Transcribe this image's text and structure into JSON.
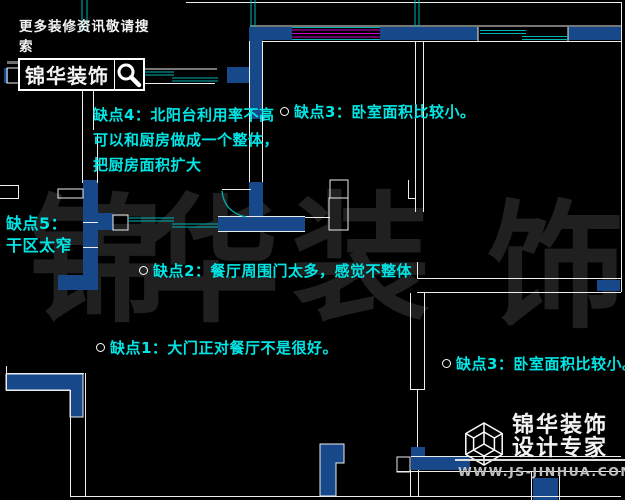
{
  "branding": {
    "header": {
      "tagline": "更多装修资讯敬请搜索",
      "logo_text": "锦华装饰",
      "search_icon": "magnifier-icon"
    },
    "footer": {
      "company": "锦华装饰",
      "slogan": "设计专家",
      "website": "WWW.JS-JINHUA.COM",
      "cube_icon": "wireframe-cube-icon"
    }
  },
  "watermark": {
    "chars": [
      "锦",
      "华",
      "装",
      "饰"
    ]
  },
  "annotations": [
    {
      "id": "defect-4",
      "marker": false,
      "lines": [
        "缺点4：北阳台利用率不高",
        "可以和厨房做成一个整体，",
        "把厨房面积扩大"
      ]
    },
    {
      "id": "defect-3-top",
      "marker": true,
      "text": "缺点3：卧室面积比较小。"
    },
    {
      "id": "defect-5",
      "marker": false,
      "lines": [
        "缺点5：",
        "干区太窄"
      ]
    },
    {
      "id": "defect-2",
      "marker": true,
      "text": "缺点2：餐厅周围门太多，感觉不整体"
    },
    {
      "id": "defect-1",
      "marker": true,
      "text": "缺点1：大门正对餐厅不是很好。"
    },
    {
      "id": "defect-3-bottom",
      "marker": true,
      "text": "缺点3：卧室面积比较小。"
    }
  ],
  "plan_legend": {
    "walls": "blue filled walls",
    "windows": "magenta triple lines",
    "sliding_doors": "teal offset double lines",
    "boundaries": "white thin lines"
  },
  "colors": {
    "background": "#000000",
    "wall_blue": "#17498a",
    "line_white": "#ededed",
    "window_magenta": "#cc00cc",
    "door_teal": "#00b3b3",
    "annotation_cyan": "#00e6e6",
    "watermark_gray": "#202020",
    "logo_white": "#f2f2f2",
    "url_gray": "#bfbfbf",
    "underline_gray": "#707070"
  }
}
